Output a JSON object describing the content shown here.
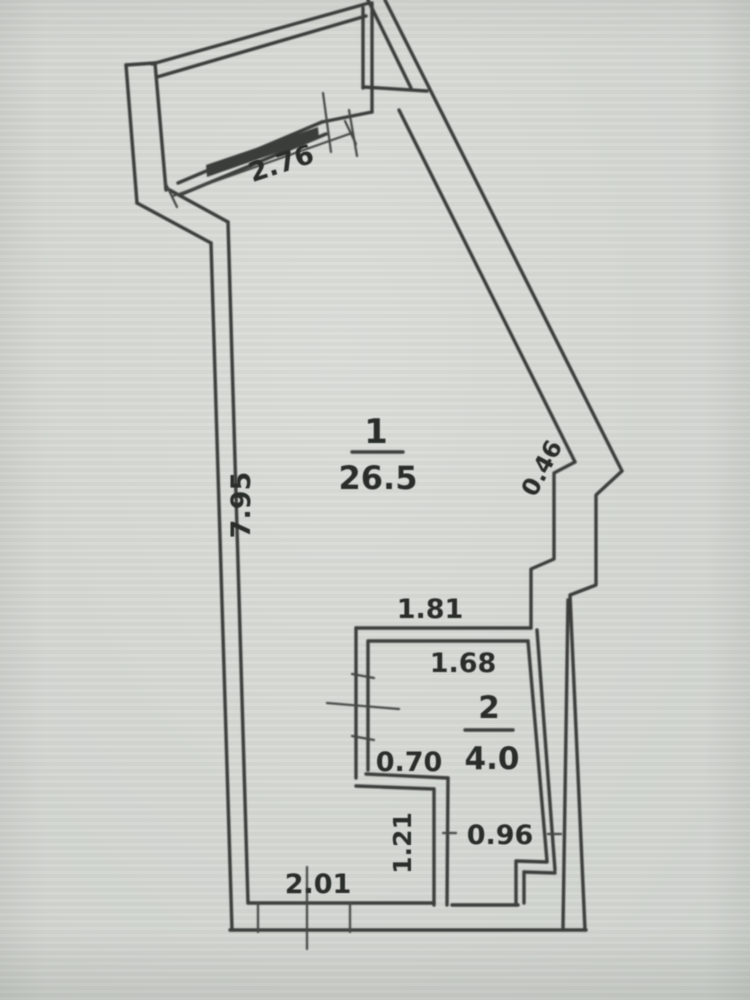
{
  "plan": {
    "rooms": [
      {
        "number": "1",
        "area": "26.5"
      },
      {
        "number": "2",
        "area": "4.0"
      }
    ],
    "dimensions": {
      "balcony_width": "2.76",
      "left_wall_length": "7.95",
      "right_wall_step": "0.46",
      "room2_outer_width": "1.81",
      "room2_inner_width": "1.68",
      "room2_jog_width": "0.70",
      "room2_left_segment": "1.21",
      "room2_lower_width": "0.96",
      "bottom_wall_width": "2.01"
    },
    "colors": {
      "paper": "#d4d7d2",
      "ink": "#3b3e3b",
      "text": "#2c2f2c"
    }
  }
}
